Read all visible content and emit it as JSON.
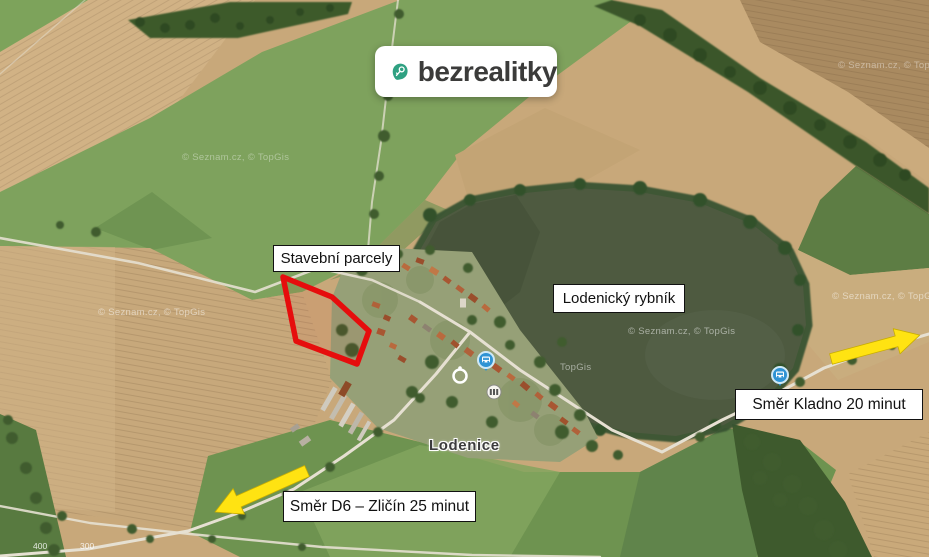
{
  "brand": {
    "name": "bezrealitky"
  },
  "annotations": {
    "parcels": "Stavební parcely",
    "pond": "Lodenický rybník",
    "direction_kladno": "Směr Kladno 20 minut",
    "direction_d6": "Směr D6 – Zličín 25 minut"
  },
  "map": {
    "town": "Lodenice",
    "watermark": "© Seznam.cz, © TopGis",
    "watermark_short": "TopGis",
    "elevation": [
      "400",
      "300"
    ],
    "colors": {
      "parcel_outline": "#e60d0d",
      "direction_arrow": "#ffe312",
      "brand_green": "#2fa182",
      "pond_water": "#4e5a40",
      "field_tan": "#c8a87a",
      "meadow_green": "#7ea25d"
    },
    "icons": {
      "brand_pin": "map-pin-with-key",
      "bus_stops": "bus-stop-pin",
      "poi_ring": "circle-poi",
      "poi_building": "building-poi"
    }
  }
}
